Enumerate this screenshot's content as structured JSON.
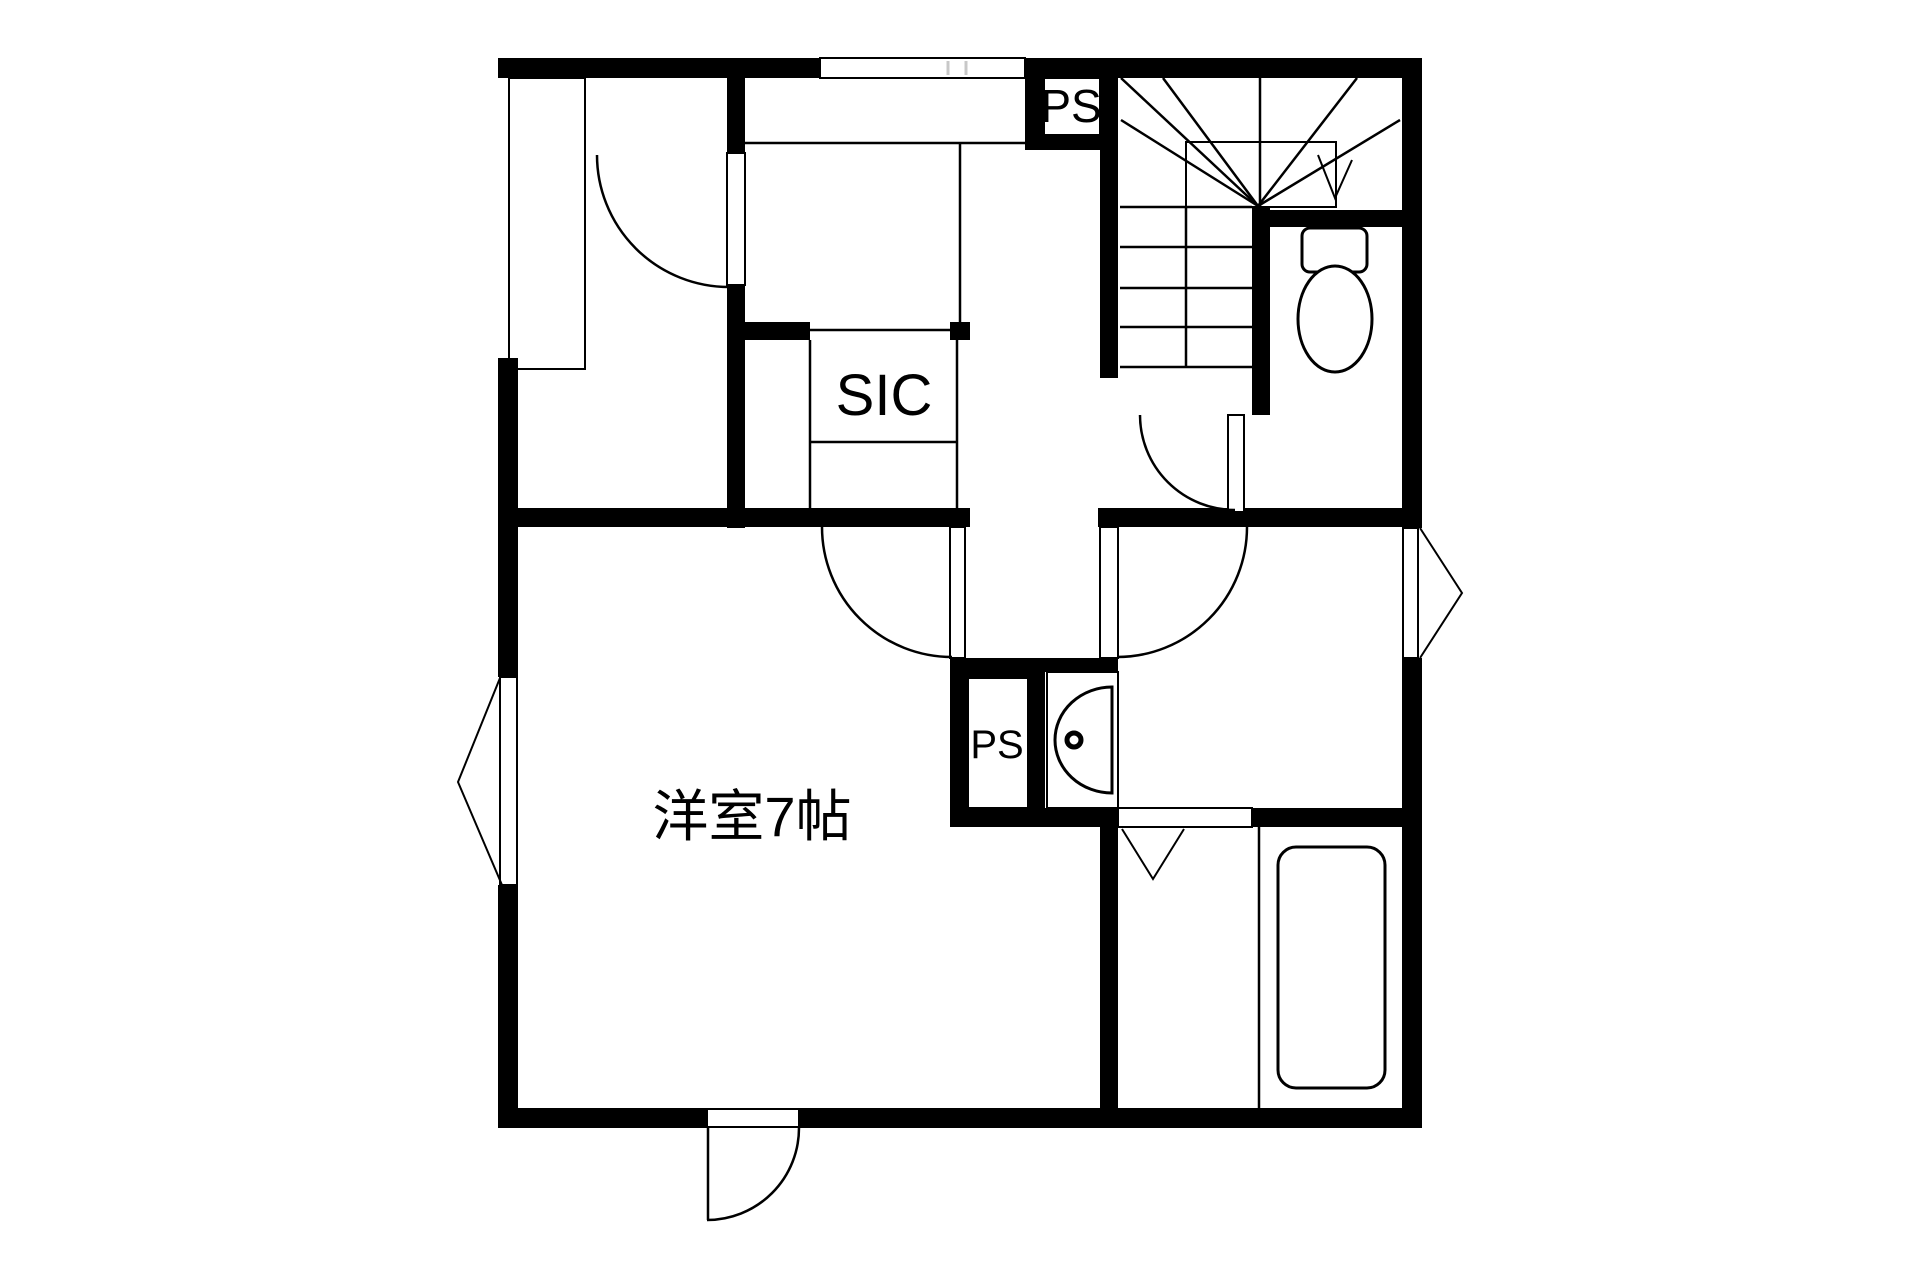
{
  "document": {
    "type": "japanese-apartment-floor-plan"
  },
  "colors": {
    "background": "#ffffff",
    "wall": "#000000",
    "line": "#000000",
    "tick": "#c8c8c8"
  },
  "labels": {
    "ps_top": "PS",
    "sic": "SIC",
    "ps_mid": "PS",
    "room": "洋室7帖"
  },
  "fixtures": {
    "toilet": "toilet with tank and bowl",
    "sink": "vanity basin with faucet dot",
    "bathtub": "rounded rectangle bathtub",
    "staircase": "winder staircase with down arrow",
    "entrance_door": "top sliding entrance door band",
    "terrace_door": "bottom swing door",
    "windows": [
      "left wall window with outward triangle",
      "right wall window with outward triangle"
    ],
    "swing_doors": [
      "closet room door",
      "western room door",
      "washroom door",
      "toilet door"
    ],
    "folding_door": "bathroom folding door V mark"
  }
}
